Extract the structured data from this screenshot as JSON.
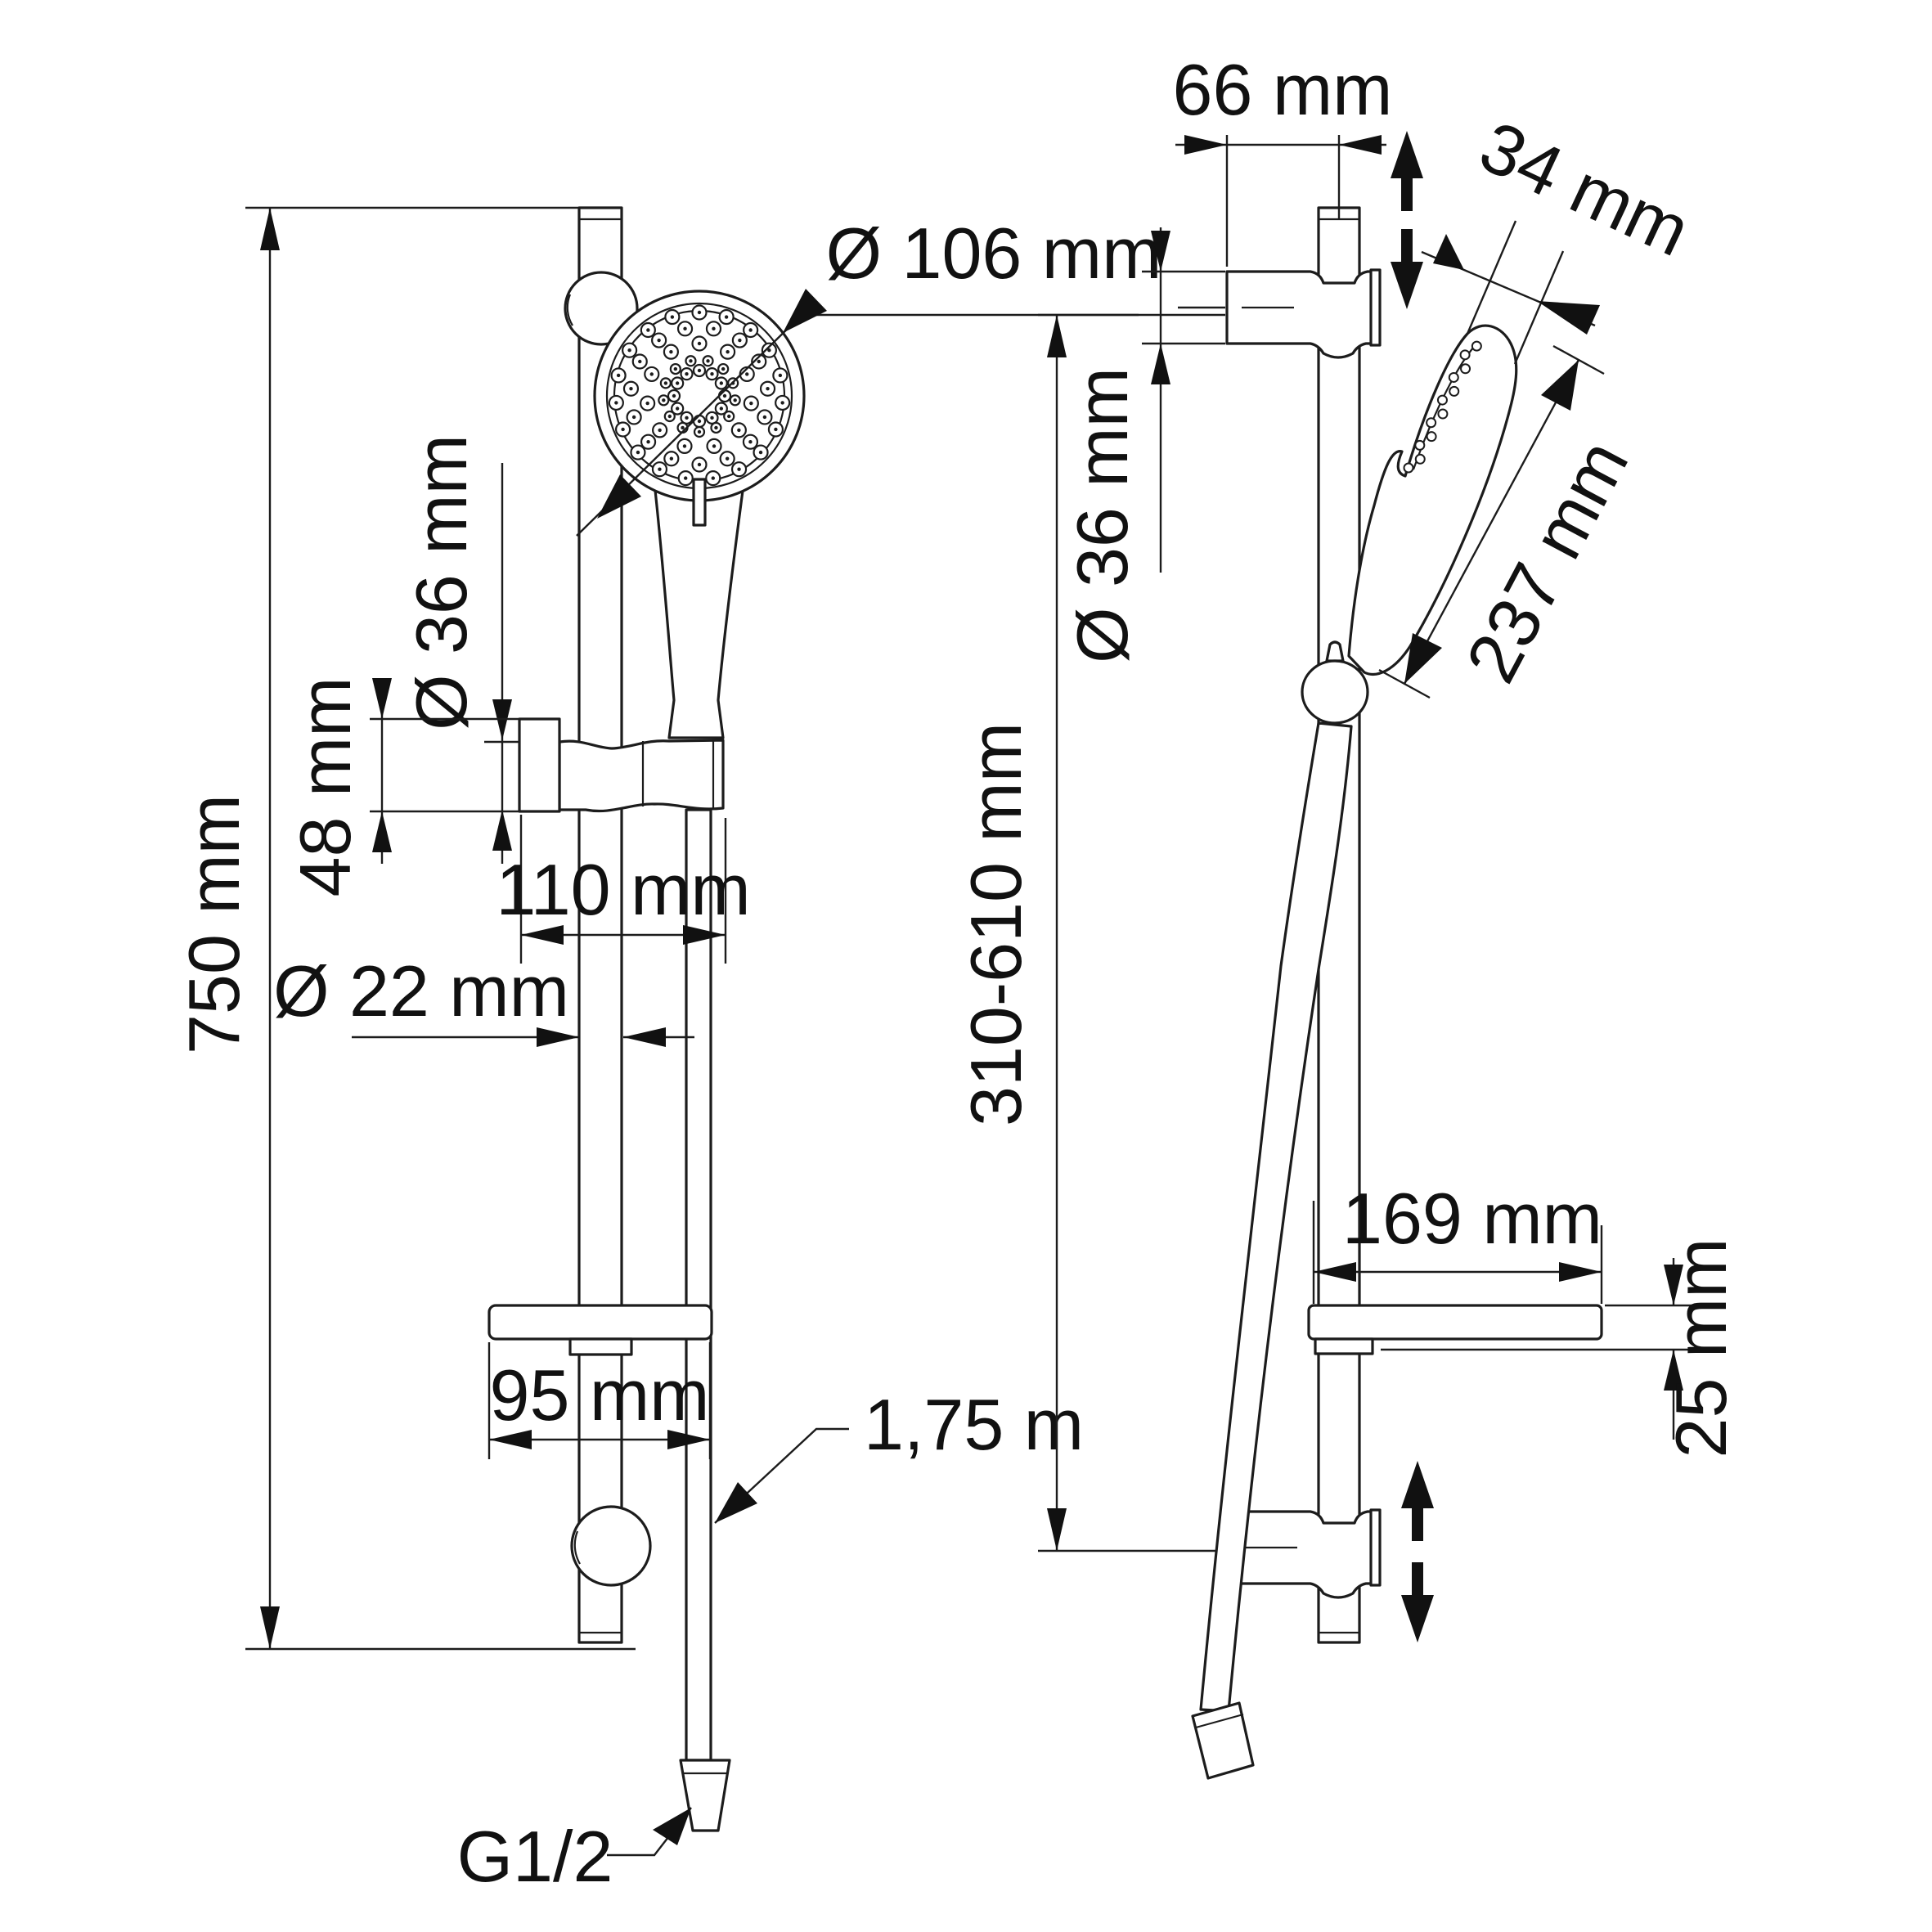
{
  "title": "Shower slide bar set - dimensional drawing",
  "colors": {
    "background": "#ffffff",
    "line": "#1c1c1c",
    "text": "#111111"
  },
  "front_view": {
    "labels": {
      "rail_height": "750 mm",
      "head_diameter": "Ø 106 mm",
      "holder_diameter": "Ø 36 mm",
      "holder_height": "48 mm",
      "holder_width": "110 mm",
      "rail_diameter": "Ø 22 mm",
      "soap_dish_width": "95 mm",
      "hose_length": "1,75 m",
      "hose_thread": "G1/2"
    }
  },
  "side_view": {
    "labels": {
      "bracket_depth": "66 mm",
      "head_thickness": "34 mm",
      "bracket_diameter": "Ø 36 mm",
      "handshower_length": "237 mm",
      "bracket_span": "310-610 mm",
      "soap_dish_depth": "169 mm",
      "soap_dish_thickness": "25 mm"
    }
  }
}
